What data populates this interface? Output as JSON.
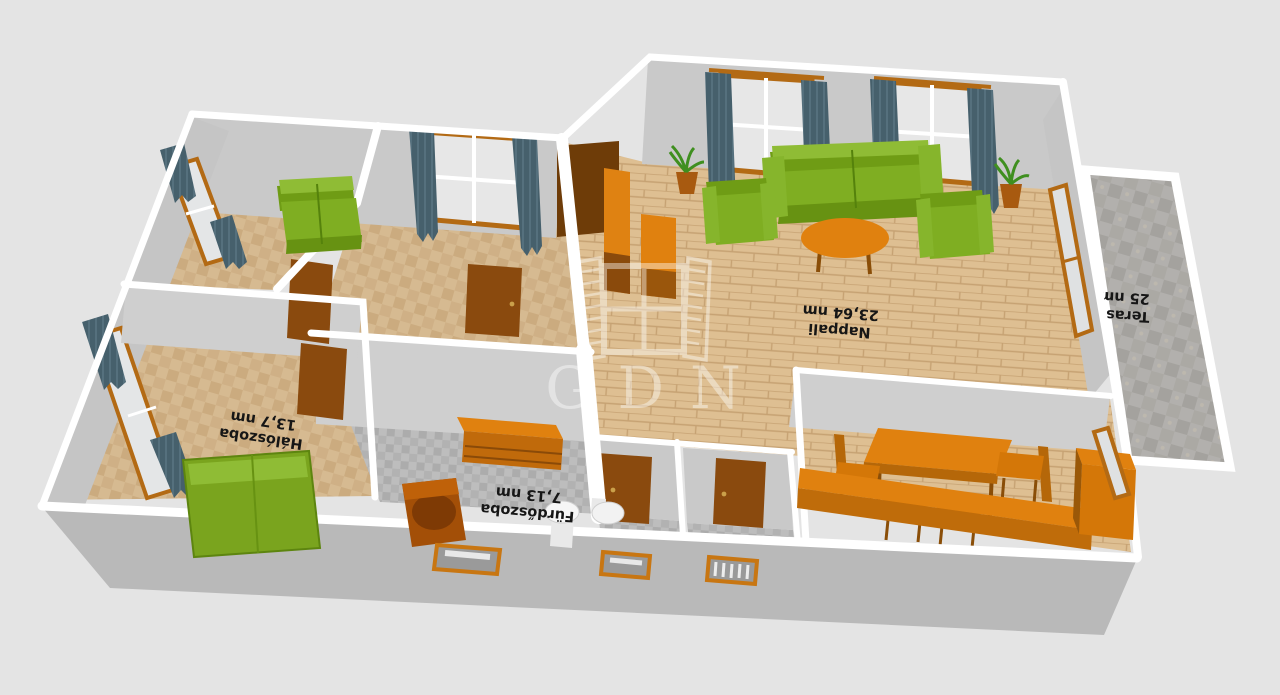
{
  "watermark": {
    "text": "GDN",
    "icon": "window-shutters-logo"
  },
  "rooms": {
    "nappali": {
      "name": "Nappali",
      "area": "23,64 nm"
    },
    "haloszoba": {
      "name": "Hálószoba",
      "area": "13,7 nm"
    },
    "furdoszoba": {
      "name": "Fürdőszoba",
      "area": "7,13 nm"
    },
    "terasz": {
      "name": "Terasz",
      "area": "25 nm"
    }
  },
  "palette": {
    "background": "#e4e4e4",
    "wall_cap": "#ffffff",
    "wall_face_exterior": "#b9b9b9",
    "wall_face_interior": "#c9c9c9",
    "floor_parquet": "#debf92",
    "floor_tile_beige": "#d6ba91",
    "floor_tile_gray": "#b5b5b5",
    "floor_terrace": "#b0aeab",
    "furniture_green": "#7aa41f",
    "furniture_orange": "#e0810f",
    "door_brown": "#8a4a0e",
    "curtain_slate": "#4a626e",
    "label_text": "#161616"
  }
}
